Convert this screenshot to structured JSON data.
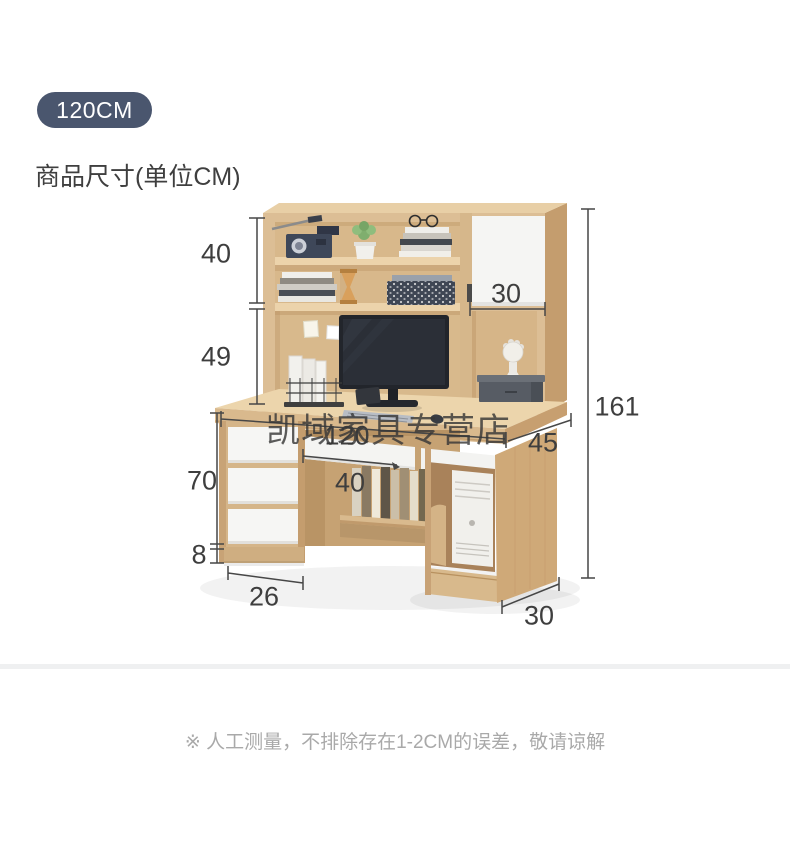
{
  "badge": {
    "label": "120CM"
  },
  "section": {
    "title": "商品尺寸(单位CM)"
  },
  "dims": {
    "upper_shelf_height": "40",
    "open_shelf_height": "49",
    "door_width": "30",
    "total_height": "161",
    "desk_width": "120",
    "desk_depth": "45",
    "tray_width": "40",
    "desk_height": "70",
    "base_height": "8",
    "pedestal_width": "26",
    "side_depth": "30"
  },
  "watermark": {
    "text": "凯域家具专营店"
  },
  "footnote": {
    "text": "※ 人工测量，不排除存在1-2CM的误差，敬请谅解"
  },
  "colors": {
    "badge_bg": "#4a566e",
    "wood": "#dcbe95",
    "wood_dark": "#c49d6e",
    "wood_light": "#ecd5ac",
    "white_panel": "#f5f5f3",
    "dim_line": "#474747",
    "note_gray": "#a9a9a9"
  }
}
